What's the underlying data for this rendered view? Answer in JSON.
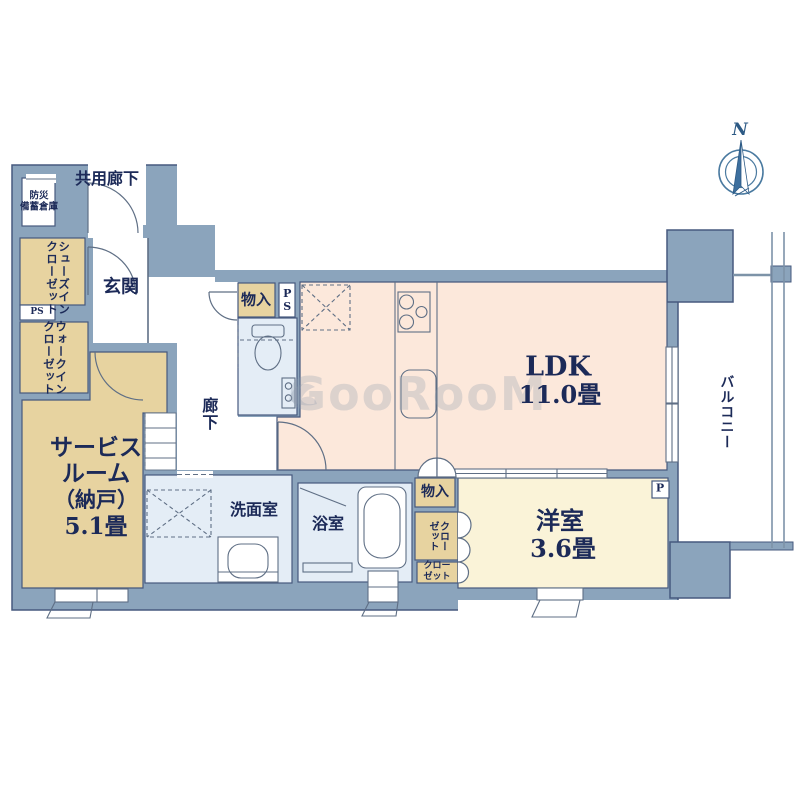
{
  "floor_plan": {
    "watermark": "GooRooM",
    "compass": {
      "north_label": "N"
    },
    "colors": {
      "wall": "#8ba4bc",
      "outline": "#46597e",
      "ldk_pink": "#fce8db",
      "room_cream": "#faf3d8",
      "storage_tan": "#e7d3a0",
      "wet_blue": "#e4edf6",
      "text_navy": "#1c2a58",
      "compass_blue": "#3d6f9e",
      "balcony_rail": "#7d93a8"
    },
    "rooms": {
      "ldk": {
        "name": "LDK",
        "size": "11.0畳"
      },
      "western_room": {
        "name": "洋室",
        "size": "3.6畳"
      },
      "service_room": {
        "line1": "サービス",
        "line2": "ルーム",
        "line3": "（納戸）",
        "line4": "5.1畳"
      },
      "entrance": {
        "name": "玄関"
      },
      "hallway": {
        "name": "廊下"
      },
      "washroom": {
        "name": "洗面室"
      },
      "bathroom": {
        "name": "浴室"
      },
      "balcony": {
        "name": "バルコニー"
      },
      "common_corridor": {
        "name": "共用廊下"
      },
      "disaster_storage": {
        "line1": "防災",
        "line2": "備蓄倉庫"
      },
      "shoes_in_closet": {
        "col1": "シューズイン",
        "col2": "クローゼット"
      },
      "walk_in_closet": {
        "col1": "ウォークイン",
        "col2": "クローゼット"
      },
      "storage_top": {
        "name": "物入"
      },
      "storage_bottom": {
        "name": "物入"
      },
      "closet_large": {
        "col1": "クロー",
        "col2": "ゼット"
      },
      "closet_small": {
        "line1": "クロー",
        "line2": "ゼット"
      },
      "pipe_space_left": {
        "name": "PS"
      },
      "pipe_space_top": {
        "name": "PS"
      },
      "pillar_mark": {
        "name": "P"
      }
    }
  }
}
